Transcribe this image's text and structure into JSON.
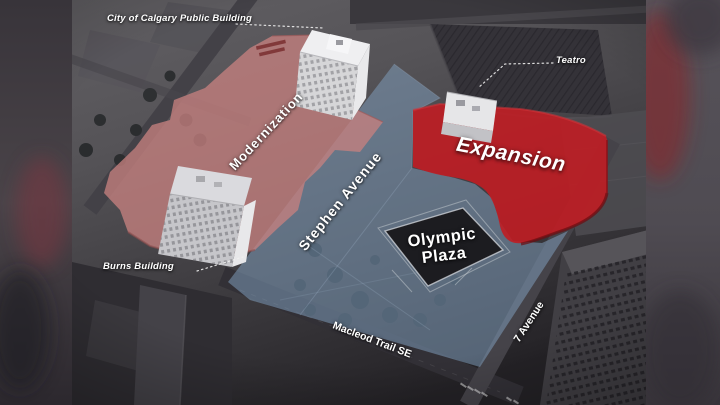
{
  "figure": {
    "description": "Annotated aerial rendering of the Olympic Plaza block in downtown Calgary showing planned Modernization and Expansion areas"
  },
  "labels": {
    "city_public_building": "City of Calgary Public Building",
    "teatro": "Teatro",
    "burns_building": "Burns Building",
    "modernization": "Modernization",
    "expansion": "Expansion",
    "stephen_avenue": "Stephen Avenue",
    "olympic_plaza": {
      "line1": "Olympic",
      "line2": "Plaza"
    },
    "macleod_trail": "Macleod Trail SE",
    "seven_avenue": "7 Avenue"
  },
  "colors": {
    "modernization_fill": "#c5807f",
    "expansion_fill": "#c01d23",
    "street_blue": "#7d9ab8",
    "label_text": "#ffffff"
  }
}
